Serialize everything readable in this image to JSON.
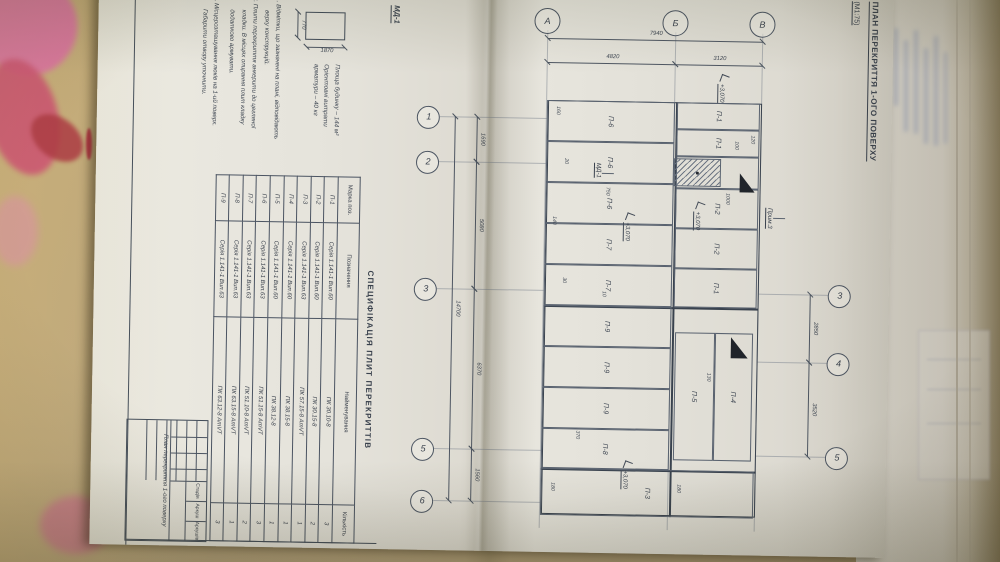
{
  "colors": {
    "desk": "#b7a47e",
    "marker_pink": "#cf5f86",
    "marker_red": "#a8333e",
    "pencil": "#3c434e",
    "paper": "#e5e3db"
  },
  "title": {
    "text": "ПЛАН ПЕРЕКРИТТЯ 1-ОГО ПОВЕРХУ",
    "scale": "(М1:75)"
  },
  "detail_md1": {
    "label": "МД-1",
    "width_dim": "770",
    "height_dim": "1870"
  },
  "material_note": [
    "Площа будинку – 144 м²",
    "Орієнтовні витрати",
    "арматури – 40 кг"
  ],
  "notes": [
    {
      "text": "1. Відмітки, що зазначені на плані, відповідають",
      "indent": false,
      "gap": false
    },
    {
      "text": "верху конструкцій.",
      "indent": true,
      "gap": false
    },
    {
      "text": "2. Плити перекриття анкерити до цегляної",
      "indent": false,
      "gap": false
    },
    {
      "text": "кладки. В місцях опирання плит кладку",
      "indent": true,
      "gap": false
    },
    {
      "text": "додатково армувати.",
      "indent": true,
      "gap": false
    },
    {
      "text": "3. Місцерозташування люків на 1-ий поверх.",
      "indent": false,
      "gap": true
    },
    {
      "text": "Габарити отвору уточнити.",
      "indent": true,
      "gap": false
    }
  ],
  "plan": {
    "elevation_label": "+3,070",
    "letter_axes": [
      {
        "label": "В",
        "y": 130
      },
      {
        "label": "Б",
        "y": 217
      },
      {
        "label": "А",
        "y": 345
      }
    ],
    "bottom_axes": [
      {
        "label": "1",
        "x": 128
      },
      {
        "label": "2",
        "x": 173
      },
      {
        "label": "3",
        "x": 300
      },
      {
        "label": "5",
        "x": 460
      },
      {
        "label": "6",
        "x": 512
      }
    ],
    "top_axes": [
      {
        "label": "3",
        "x": 300
      },
      {
        "label": "4",
        "x": 368
      },
      {
        "label": "5",
        "x": 462
      }
    ],
    "v_dims": [
      {
        "label": "7940",
        "x": 48,
        "y1": 130,
        "y2": 345
      },
      {
        "label": "3120",
        "x": 72,
        "y1": 130,
        "y2": 217
      },
      {
        "label": "4820",
        "x": 72,
        "y1": 217,
        "y2": 345
      }
    ],
    "h_dims": [
      {
        "label": "1690",
        "y": 414,
        "x1": 128,
        "x2": 173
      },
      {
        "label": "5080",
        "y": 414,
        "x1": 173,
        "x2": 300
      },
      {
        "label": "6370",
        "y": 414,
        "x1": 300,
        "x2": 460
      },
      {
        "label": "1560",
        "y": 414,
        "x1": 460,
        "x2": 512
      },
      {
        "label": "14700",
        "y": 436,
        "x1": 128,
        "x2": 512
      },
      {
        "label": "2850",
        "y": 78,
        "x1": 300,
        "x2": 368
      },
      {
        "label": "3520",
        "y": 78,
        "x1": 368,
        "x2": 462
      }
    ],
    "plates": [
      {
        "label": "П-1",
        "x": 110,
        "y": 132,
        "w": 27,
        "h": 83
      },
      {
        "label": "П-1",
        "x": 137,
        "y": 132,
        "w": 27,
        "h": 83
      },
      {
        "label": "П-2",
        "x": 196,
        "y": 132,
        "w": 40,
        "h": 83
      },
      {
        "label": "П-2",
        "x": 236,
        "y": 132,
        "w": 40,
        "h": 83
      },
      {
        "label": "П-1",
        "x": 276,
        "y": 132,
        "w": 39,
        "h": 83
      },
      {
        "label": "П-6",
        "x": 110,
        "y": 217,
        "w": 41,
        "h": 128
      },
      {
        "label": "П-6",
        "x": 151,
        "y": 217,
        "w": 41,
        "h": 128
      },
      {
        "label": "П-6",
        "x": 192,
        "y": 217,
        "w": 41,
        "h": 128
      },
      {
        "label": "П-7",
        "x": 233,
        "y": 217,
        "w": 41,
        "h": 128
      },
      {
        "label": "П-7",
        "x": 274,
        "y": 217,
        "w": 41,
        "h": 128
      },
      {
        "label": "П-9",
        "x": 315,
        "y": 217,
        "w": 41,
        "h": 128
      },
      {
        "label": "П-9",
        "x": 356,
        "y": 217,
        "w": 41,
        "h": 128
      },
      {
        "label": "П-9",
        "x": 397,
        "y": 217,
        "w": 41,
        "h": 128
      },
      {
        "label": "П-8",
        "x": 438,
        "y": 217,
        "w": 40,
        "h": 128
      },
      {
        "label": "П-4",
        "x": 340,
        "y": 135,
        "w": 128,
        "h": 38
      },
      {
        "label": "П-5",
        "x": 340,
        "y": 173,
        "w": 128,
        "h": 40
      },
      {
        "label": "П-3",
        "x": 478,
        "y": 132,
        "w": 47,
        "h": 213
      }
    ],
    "opening": {
      "x": 164,
      "y": 132,
      "w": 32,
      "h": 83,
      "hatch_y": 170,
      "hatch_h": 45
    },
    "small_dims": [
      {
        "label": "160",
        "x": 116,
        "y": 331
      },
      {
        "label": "20",
        "x": 168,
        "y": 322
      },
      {
        "label": "140",
        "x": 226,
        "y": 333
      },
      {
        "label": "30",
        "x": 287,
        "y": 322
      },
      {
        "label": "10",
        "x": 300,
        "y": 282
      },
      {
        "label": "120",
        "x": 142,
        "y": 136
      },
      {
        "label": "100",
        "x": 148,
        "y": 152
      },
      {
        "label": "1000",
        "x": 200,
        "y": 160
      },
      {
        "label": "750",
        "x": 196,
        "y": 280
      },
      {
        "label": "130",
        "x": 380,
        "y": 176
      },
      {
        "label": "370",
        "x": 440,
        "y": 306
      },
      {
        "label": "180",
        "x": 492,
        "y": 204
      },
      {
        "label": "180",
        "x": 492,
        "y": 330
      }
    ],
    "elevations": [
      {
        "x": 82,
        "y": 164
      },
      {
        "x": 210,
        "y": 186
      },
      {
        "x": 222,
        "y": 256
      },
      {
        "x": 470,
        "y": 254
      }
    ],
    "callouts": [
      {
        "label": "МД-1",
        "x": 172,
        "y": 289
      },
      {
        "label": "Прим.3",
        "x": 214,
        "y": 117
      }
    ]
  },
  "spec_table": {
    "title": "СПЕЦИФІКАЦІЯ ПЛИТ ПЕРЕКРИТТІВ",
    "columns": [
      "Марка поз.",
      "Позначення",
      "Найменування",
      "Кількість"
    ],
    "rows": [
      [
        "П-1",
        "Серія 1.141-1 Вип.60",
        "ПК 30.10-8",
        "3"
      ],
      [
        "П-2",
        "Серія 1.141-1 Вип.60",
        "ПК 30.15-8",
        "2"
      ],
      [
        "П-3",
        "Серія 1.141-1 Вип.63",
        "ПК 57.15-8 АтVТ",
        "1"
      ],
      [
        "П-4",
        "Серія 1.141-1 Вип.60",
        "ПК 38.15-8",
        "1"
      ],
      [
        "П-5",
        "Серія 1.141-1 Вип.60",
        "ПК 38.12-8",
        "1"
      ],
      [
        "П-6",
        "Серія 1.141-1 Вип.63",
        "ПК 51.15-8 АтVТ",
        "3"
      ],
      [
        "П-7",
        "Серія 1.141-1 Вип.63",
        "ПК 51.10-8 АтVТ",
        "2"
      ],
      [
        "П-8",
        "Серія 1.141-1 Вип.63",
        "ПК 63.15-8 АтVТ",
        "1"
      ],
      [
        "П-9",
        "Серія 1.141-1 Вип.63",
        "ПК 63.12-8 АтVТ",
        "3"
      ]
    ]
  },
  "stamp": {
    "doc_title": "План перекриття 1-ого поверху",
    "cells": [
      "Стадія",
      "Аркуш",
      "Аркушів"
    ]
  }
}
